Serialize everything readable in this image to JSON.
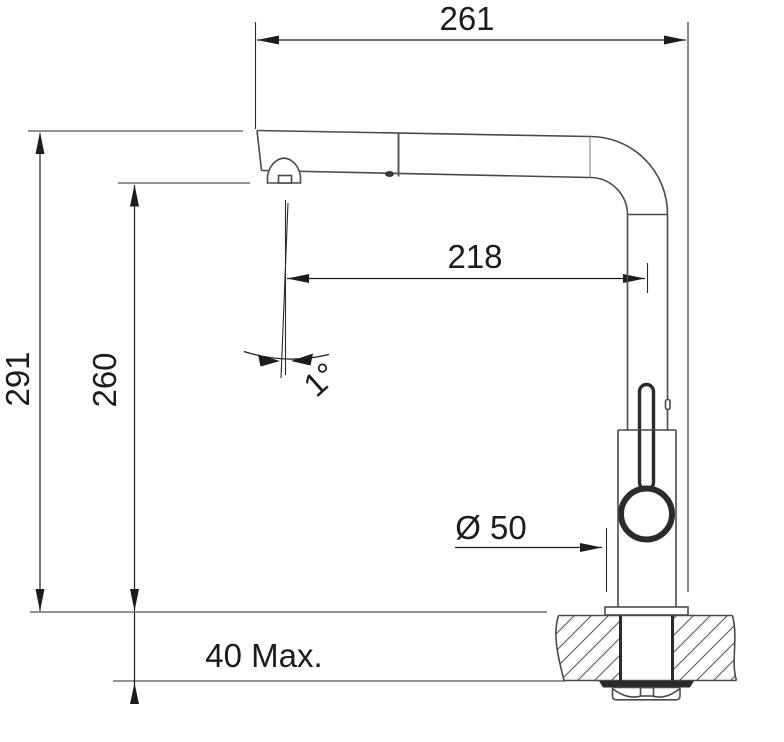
{
  "dimensions": {
    "spout_width": "261",
    "total_height": "291",
    "outlet_height": "260",
    "reach": "218",
    "outlet_angle": "1°",
    "base_diameter": "Ø 50",
    "mounting_thickness": "40 Max."
  },
  "colors": {
    "outline": "#4a4a4a",
    "dimension": "#1c1c1c",
    "hatch": "#5a5a5a",
    "background": "#ffffff"
  }
}
